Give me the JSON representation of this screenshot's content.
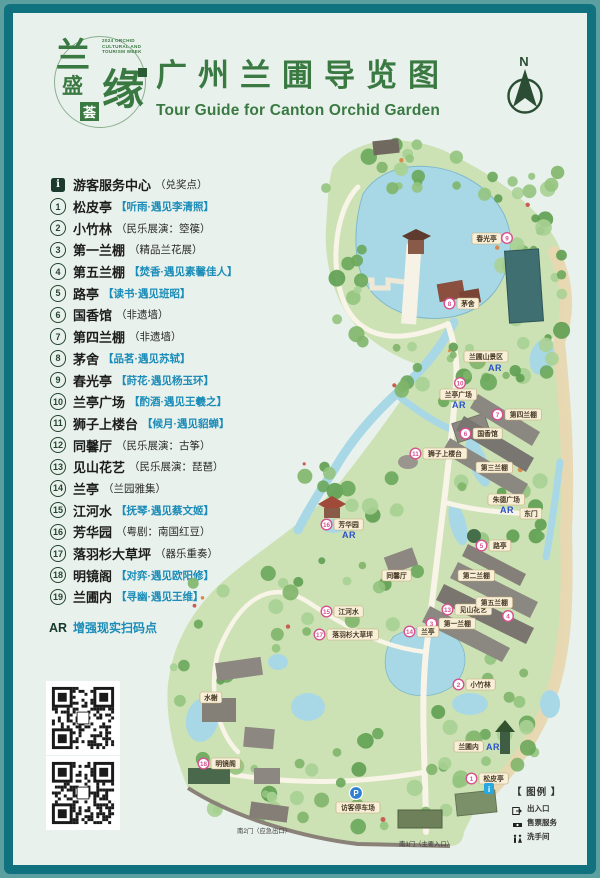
{
  "colors": {
    "frame_outer": "#5b9fa0",
    "frame_border": "#11727f",
    "page_bg": "#e9f1ec",
    "title_green": "#3a7a42",
    "bracket_blue": "#1b8cb8",
    "legend_ink": "#24442f",
    "map_pink": "#d6518f",
    "ar_blue": "#2b50c8",
    "water_blue": "#a8d8e6",
    "park_green": "#cde2b4",
    "tag_cream": "#f8efd8",
    "info_blue": "#29a7e1",
    "parking_blue": "#2e7fd4"
  },
  "header": {
    "logo": {
      "chars": [
        "兰",
        "盛",
        "荟",
        "缘"
      ],
      "week_text": "2024 ORCHID CULTURAL AND TOURISM WEEK"
    },
    "title": "广州兰圃导览图",
    "subtitle": "Tour Guide for Canton Orchid Garden",
    "north_label": "N"
  },
  "legend": {
    "items": [
      {
        "marker": "i",
        "name": "游客服务中心",
        "note": "（兑奖点）",
        "style": "paren"
      },
      {
        "marker": "1",
        "name": "松皮亭",
        "note": "【听雨·遇见李清照】",
        "style": "bracket"
      },
      {
        "marker": "2",
        "name": "小竹林",
        "note": "（民乐展演：箜篌）",
        "style": "paren"
      },
      {
        "marker": "3",
        "name": "第一兰棚",
        "note": "（精品兰花展）",
        "style": "paren"
      },
      {
        "marker": "4",
        "name": "第五兰棚",
        "note": "【焚香·遇见素馨佳人】",
        "style": "bracket"
      },
      {
        "marker": "5",
        "name": "路亭",
        "note": "【读书·遇见班昭】",
        "style": "bracket"
      },
      {
        "marker": "6",
        "name": "国香馆",
        "note": "（非遗墙）",
        "style": "paren"
      },
      {
        "marker": "7",
        "name": "第四兰棚",
        "note": "（非遗墙）",
        "style": "paren"
      },
      {
        "marker": "8",
        "name": "茅舍",
        "note": "【品茗·遇见苏轼】",
        "style": "bracket"
      },
      {
        "marker": "9",
        "name": "春光亭",
        "note": "【莳花·遇见杨玉环】",
        "style": "bracket"
      },
      {
        "marker": "10",
        "name": "兰亭广场",
        "note": "【酌酒·遇见王羲之】",
        "style": "bracket"
      },
      {
        "marker": "11",
        "name": "狮子上楼台",
        "note": "【候月·遇见貂蝉】",
        "style": "bracket"
      },
      {
        "marker": "12",
        "name": "同馨厅",
        "note": "（民乐展演：古筝）",
        "style": "paren"
      },
      {
        "marker": "13",
        "name": "见山花艺",
        "note": "（民乐展演：琵琶）",
        "style": "paren"
      },
      {
        "marker": "14",
        "name": "兰亭",
        "note": "（兰园雅集）",
        "style": "paren"
      },
      {
        "marker": "15",
        "name": "江河水",
        "note": "【抚琴·遇见蔡文姬】",
        "style": "bracket"
      },
      {
        "marker": "16",
        "name": "芳华园",
        "note": "（粤剧：南国红豆）",
        "style": "paren"
      },
      {
        "marker": "17",
        "name": "落羽杉大草坪",
        "note": "（器乐重奏）",
        "style": "paren"
      },
      {
        "marker": "18",
        "name": "明镜阁",
        "note": "【对弈·遇见欧阳修】",
        "style": "bracket"
      },
      {
        "marker": "19",
        "name": "兰圃内",
        "note": "【寻幽·遇见王维】",
        "style": "bracket"
      }
    ],
    "ar_row": {
      "label": "AR",
      "text": "增强现实扫码点"
    }
  },
  "map": {
    "labels": [
      {
        "kind": "tag",
        "text": "春光亭",
        "x": 314,
        "y": 101
      },
      {
        "kind": "num",
        "num": "9",
        "x": 349,
        "y": 106
      },
      {
        "kind": "poi",
        "num": "8",
        "text": "茅舍",
        "x": 286,
        "y": 166
      },
      {
        "kind": "tag",
        "text": "兰圃山景区",
        "x": 306,
        "y": 219
      },
      {
        "kind": "ar",
        "x": 330,
        "y": 239
      },
      {
        "kind": "num",
        "num": "10",
        "x": 302,
        "y": 251
      },
      {
        "kind": "tag",
        "text": "兰亭广场",
        "x": 282,
        "y": 257
      },
      {
        "kind": "ar",
        "x": 294,
        "y": 276
      },
      {
        "kind": "poi",
        "num": "7",
        "text": "第四兰棚",
        "x": 334,
        "y": 277
      },
      {
        "kind": "poi",
        "num": "6",
        "text": "国香馆",
        "x": 302,
        "y": 296
      },
      {
        "kind": "poi",
        "num": "11",
        "text": "狮子上楼台",
        "x": 252,
        "y": 316
      },
      {
        "kind": "tag",
        "text": "第三兰棚",
        "x": 318,
        "y": 330
      },
      {
        "kind": "tag",
        "text": "朱德广场",
        "x": 330,
        "y": 362
      },
      {
        "kind": "ar",
        "x": 342,
        "y": 381
      },
      {
        "kind": "tag",
        "text": "东门",
        "x": 362,
        "y": 376
      },
      {
        "kind": "poi",
        "num": "5",
        "text": "路亭",
        "x": 318,
        "y": 408
      },
      {
        "kind": "poi",
        "num": "16",
        "text": "芳华园",
        "x": 163,
        "y": 387
      },
      {
        "kind": "ar",
        "x": 184,
        "y": 406
      },
      {
        "kind": "tag",
        "text": "同馨厅",
        "x": 224,
        "y": 438
      },
      {
        "kind": "tag",
        "text": "第二兰棚",
        "x": 300,
        "y": 438
      },
      {
        "kind": "poi",
        "num": "13",
        "text": "见山花艺",
        "x": 284,
        "y": 472
      },
      {
        "kind": "poi",
        "num": "3",
        "text": "第一兰棚",
        "x": 268,
        "y": 486
      },
      {
        "kind": "tag",
        "text": "第五兰棚",
        "x": 318,
        "y": 465
      },
      {
        "kind": "num",
        "num": "4",
        "x": 350,
        "y": 484
      },
      {
        "kind": "poi",
        "num": "14",
        "text": "兰亭",
        "x": 246,
        "y": 494
      },
      {
        "kind": "poi",
        "num": "15",
        "text": "江河水",
        "x": 163,
        "y": 474
      },
      {
        "kind": "poi",
        "num": "17",
        "text": "落羽杉大草坪",
        "x": 156,
        "y": 497
      },
      {
        "kind": "poi",
        "num": "2",
        "text": "小竹林",
        "x": 295,
        "y": 547
      },
      {
        "kind": "tag",
        "text": "水榭",
        "x": 42,
        "y": 560
      },
      {
        "kind": "poi",
        "num": "18",
        "text": "明镜阁",
        "x": 40,
        "y": 626
      },
      {
        "kind": "tag",
        "text": "兰圃内",
        "x": 296,
        "y": 609
      },
      {
        "kind": "ar",
        "x": 328,
        "y": 618
      },
      {
        "kind": "poi",
        "num": "1",
        "text": "松皮亭",
        "x": 308,
        "y": 641
      },
      {
        "kind": "info",
        "x": 331,
        "y": 657
      },
      {
        "kind": "parking",
        "x": 198,
        "y": 661
      },
      {
        "kind": "tag",
        "text": "访客停车场",
        "x": 178,
        "y": 670
      },
      {
        "kind": "gate",
        "text": "南2门（应急出口）",
        "x": 106,
        "y": 701
      },
      {
        "kind": "gate",
        "text": "南1门（主要入口）",
        "x": 268,
        "y": 714
      }
    ],
    "legend_box": {
      "title": "【 图例 】",
      "items": [
        {
          "icon": "entrance-icon",
          "label": "出入口"
        },
        {
          "icon": "ticket-icon",
          "label": "售票服务"
        },
        {
          "icon": "restroom-icon",
          "label": "洗手间"
        }
      ]
    }
  }
}
